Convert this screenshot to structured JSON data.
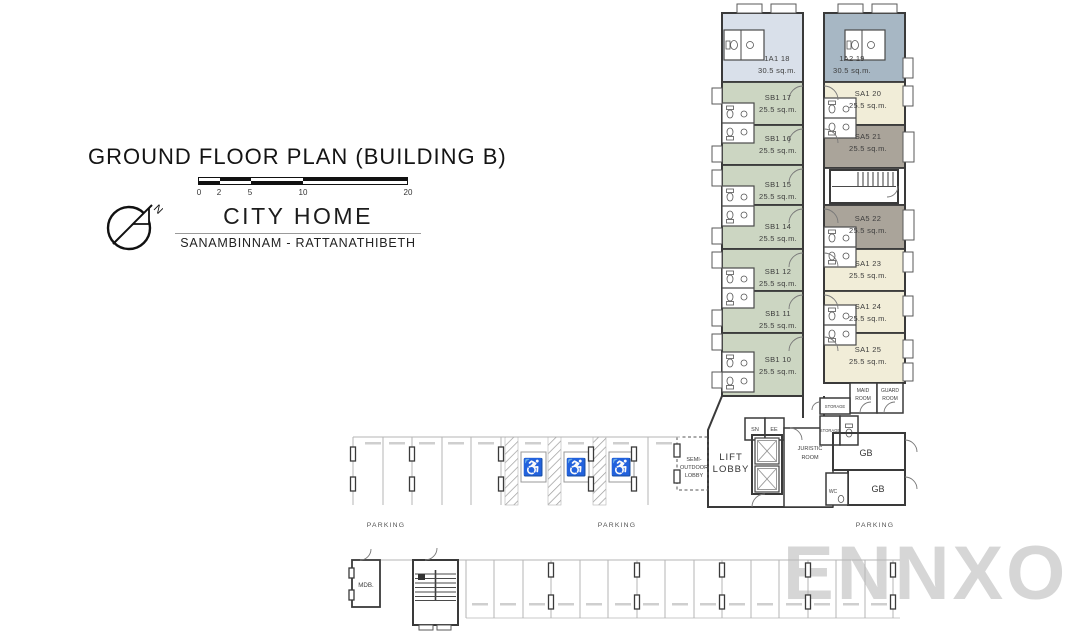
{
  "title_block": {
    "title": "GROUND FLOOR PLAN (BUILDING B)",
    "scale_ticks": [
      "0",
      "2",
      "5",
      "10",
      "20"
    ],
    "north_label": "N",
    "project_name": "CITY HOME",
    "project_location": "SANAMBINNAM - RATTANATHIBETH"
  },
  "units": [
    {
      "id": "1A1 18",
      "area": "30.5 sq.m."
    },
    {
      "id": "1A2 19",
      "area": "30.5 sq.m."
    },
    {
      "id": "SB1 17",
      "area": "25.5 sq.m."
    },
    {
      "id": "SB1 16",
      "area": "25.5 sq.m."
    },
    {
      "id": "SB1 15",
      "area": "25.5 sq.m."
    },
    {
      "id": "SB1 14",
      "area": "25.5 sq.m."
    },
    {
      "id": "SB1 12",
      "area": "25.5 sq.m."
    },
    {
      "id": "SB1 11",
      "area": "25.5 sq.m."
    },
    {
      "id": "SB1 10",
      "area": "25.5 sq.m."
    },
    {
      "id": "SA1 20",
      "area": "25.5 sq.m."
    },
    {
      "id": "SA5 21",
      "area": "25.5 sq.m."
    },
    {
      "id": "SA5 22",
      "area": "25.5 sq.m."
    },
    {
      "id": "SA1 23",
      "area": "25.5 sq.m."
    },
    {
      "id": "SA1 24",
      "area": "25.5 sq.m."
    },
    {
      "id": "SA1 25",
      "area": "25.5 sq.m."
    }
  ],
  "rooms": {
    "lift_lobby": [
      "LIFT",
      "LOBBY"
    ],
    "semi_outdoor_lobby": [
      "SEMI-",
      "OUTDOOR",
      "LOBBY"
    ],
    "juristic_room": [
      "JURISTIC",
      "ROOM"
    ],
    "maid_room": [
      "MAID",
      "ROOM"
    ],
    "guard_room": [
      "GUARD",
      "ROOM"
    ],
    "storage_upper": "STORAGE",
    "storage_lower": "STORAGE",
    "sn": "SN",
    "ee": "EE",
    "gb_upper": "GB",
    "gb_lower": "GB",
    "wc": "WC",
    "mdb": "MDB."
  },
  "parking_labels": [
    "PARKING",
    "PARKING",
    "PARKING"
  ],
  "watermark": "ENNXO",
  "icons": {
    "accessible_parking_icon": "♿",
    "north_arrow_icon": "compass-circle"
  },
  "colors": {
    "unit_1a1": "#d9e0ea",
    "unit_1a2": "#a7b7c4",
    "unit_sb1": "#ccd6c2",
    "unit_sa1": "#f1edd8",
    "unit_sa5": "#aaa49a",
    "unit_sa5_balcony": "#b9b3a8",
    "wall": "#3a3a3a",
    "parking_line": "#b5b5b5",
    "watermark_gray": "#d6d6d6"
  }
}
